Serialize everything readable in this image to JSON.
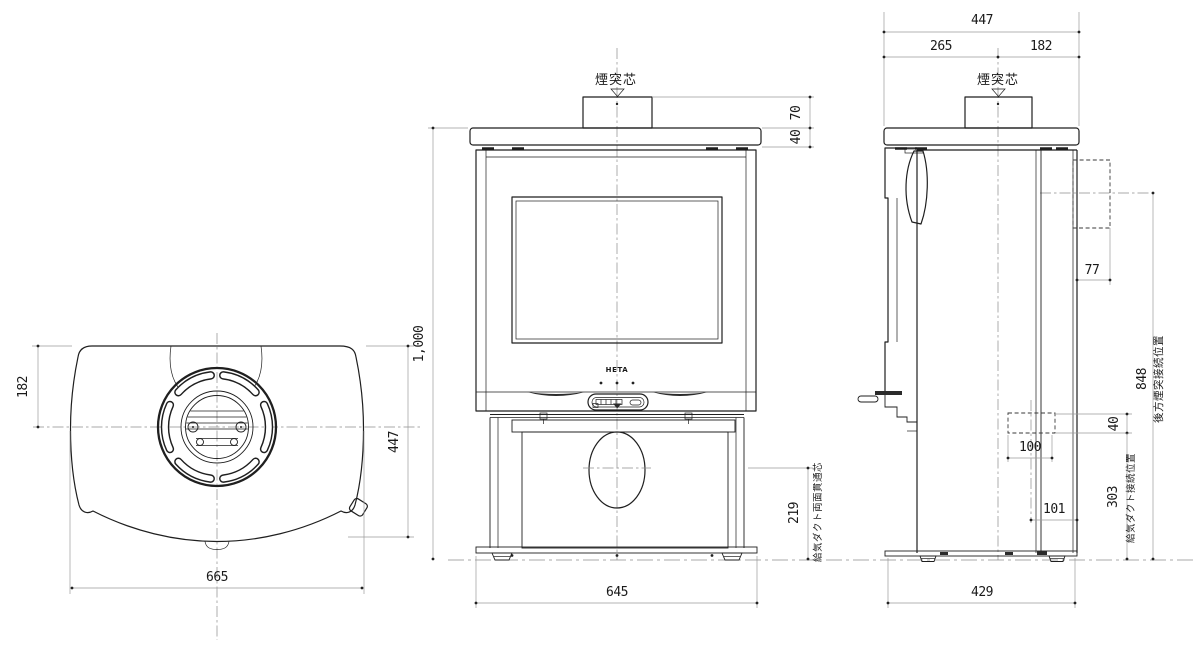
{
  "labels": {
    "flue_center_front": "煙突芯",
    "flue_center_side": "煙突芯",
    "logo": "HETA",
    "rear_flue_note": "後方煙突接続位置",
    "duct_side_note": "給気ダクト接続位置",
    "duct_front_note": "給気ダクト両面貫通芯"
  },
  "dims": {
    "top_flue_offset": "182",
    "top_depth": "447",
    "top_width": "665",
    "front_height": "1,000",
    "front_width": "645",
    "front_collar_height": "70",
    "front_plate_thickness": "40",
    "front_duct_height": "219",
    "side_total_depth": "447",
    "side_front_to_flue": "265",
    "side_flue_to_rear": "182",
    "side_rear_gap": "77",
    "side_rear_flue_height": "848",
    "side_duct_height": "40",
    "side_duct_width": "100",
    "side_duct_to_rear": "101",
    "side_duct_floor_height": "303",
    "side_base_depth": "429"
  }
}
